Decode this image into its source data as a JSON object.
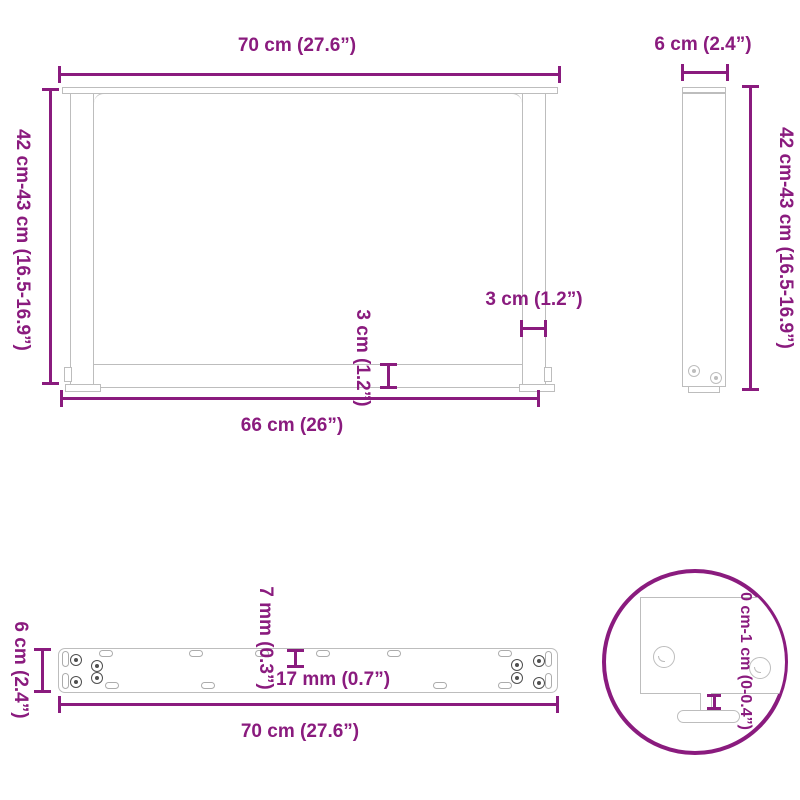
{
  "colors": {
    "accent": "#8A1B7E",
    "line": "#BDBDBD",
    "background": "#FFFFFF"
  },
  "views": {
    "front": {
      "top_width": "70 cm (27.6”)",
      "height": "42 cm-43 cm (16.5-16.9”)",
      "bar_thickness": "3 cm (1.2”)",
      "leg_thickness": "3 cm (1.2”)",
      "bottom_width": "66 cm (26”)"
    },
    "side": {
      "width": "6 cm (2.4”)",
      "height": "42 cm-43 cm (16.5-16.9”)"
    },
    "plate": {
      "depth": "6 cm (2.4”)",
      "slot_width": "7 mm (0.3”)",
      "slot_length": "17 mm (0.7”)",
      "width": "70 cm (27.6”)"
    },
    "foot_detail": {
      "adjustable_height": "0 cm-1 cm (0-0.4”)"
    }
  }
}
